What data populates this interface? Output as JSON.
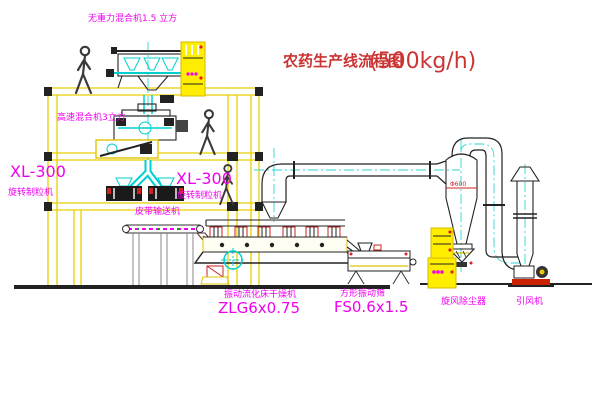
{
  "title": {
    "text": "农药生产线流程图",
    "capacity": "(500kg/h)"
  },
  "labels": {
    "gravity_mixer": "无重力混合机1.5 立方",
    "high_speed_mixer": "高速混合机3立方",
    "xl300_left": "XL-300",
    "granulator_left": "旋转制粒机",
    "xl300_mid": "XL-300",
    "granulator_mid": "旋转制粒机",
    "belt_conveyor": "皮带输送机",
    "dryer": "振动流化床干燥机",
    "dryer_model": "ZLG6x0.75",
    "sieve": "方形振动筛",
    "sieve_model": "FS0.6x1.5",
    "cyclone": "旋风除尘器",
    "cyclone_dia": "Φ600",
    "fan": "引风机"
  },
  "colors": {
    "label_magenta": "#f000f0",
    "title_red": "#cc3333",
    "structure_yellow": "#e8d000",
    "detail_cyan": "#00cfcf",
    "line_black": "#222222"
  }
}
